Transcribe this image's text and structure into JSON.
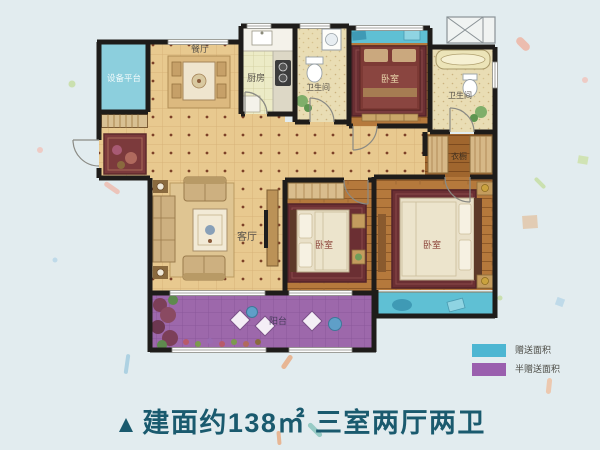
{
  "title": {
    "marker": "▲",
    "text": "建面约138㎡ 三室两厅两卫",
    "color": "#1a5a6e"
  },
  "legend": {
    "items": [
      {
        "label": "赠送面积",
        "color": "#4db6d2"
      },
      {
        "label": "半赠送面积",
        "color": "#9a5fae"
      }
    ]
  },
  "rooms": {
    "equipment_platform": "设备平台",
    "dining": "餐厅",
    "kitchen": "厨房",
    "bathroom_top": "卫生间",
    "bedroom_top": "卧室",
    "bathroom_right": "卫生间",
    "closet": "衣橱",
    "living": "客厅",
    "bedroom_middle": "卧室",
    "bedroom_master": "卧室",
    "balcony": "阳台"
  },
  "colors": {
    "gift_area": "#5fc0d4",
    "half_gift_area": "#9d68ab",
    "background": "#e2ecef",
    "floor_tile": "#e8c98f",
    "wood_floor": "#b5793c",
    "wall": "#1e1c1a",
    "title_text": "#1a5a6e"
  }
}
